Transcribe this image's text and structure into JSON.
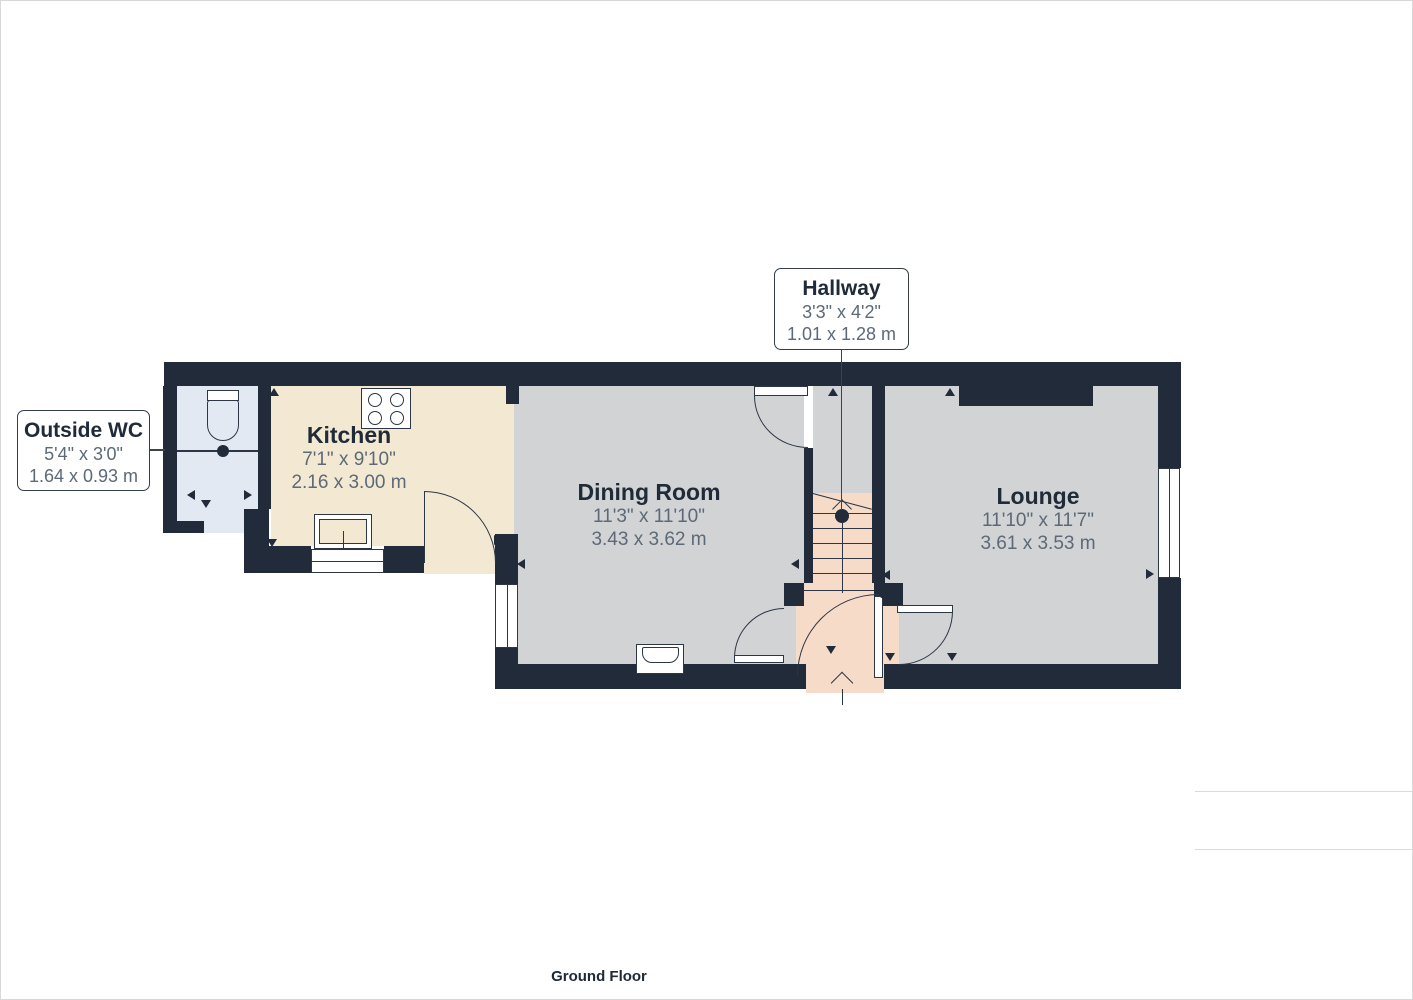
{
  "title": "Ground Floor plan",
  "floor_label": "Ground Floor",
  "rooms": {
    "outside_wc": {
      "name": "Outside WC",
      "imperial": "5'4\" x 3'0\"",
      "metric": "1.64 x 0.93 m"
    },
    "kitchen": {
      "name": "Kitchen",
      "imperial": "7'1\" x 9'10\"",
      "metric": "2.16 x 3.00 m"
    },
    "dining": {
      "name": "Dining Room",
      "imperial": "11'3\" x 11'10\"",
      "metric": "3.43 x 3.62 m"
    },
    "hallway": {
      "name": "Hallway",
      "imperial": "3'3\" x 4'2\"",
      "metric": "1.01 x 1.28 m"
    },
    "lounge": {
      "name": "Lounge",
      "imperial": "11'10\" x 11'7\"",
      "metric": "3.61 x 3.53 m"
    }
  },
  "sidebar": {
    "area_title": "Approximate total area",
    "area_superscript": "(1)",
    "area_ft_value": "397 ft",
    "area_ft_sup": "2",
    "area_m_value": "36.9 m",
    "area_m_sup": "2",
    "footnote": "(1) Excluding balconies and terraces",
    "disclaimer": "Calculations reference the RICS IPMS 3C standard. Measurements are approximate and not to scale. This floor plan is intended for illustration only.",
    "brand_regular": "GIRAFFE",
    "brand_bold": "360"
  },
  "colors": {
    "wall": "#212b39",
    "floor_grey": "#d2d3d5",
    "floor_cream": "#f3e9d2",
    "floor_blue": "#e3e9f3",
    "floor_pink": "#f6dbc8",
    "dim_text": "#5d6977",
    "title_text": "#202b39"
  }
}
